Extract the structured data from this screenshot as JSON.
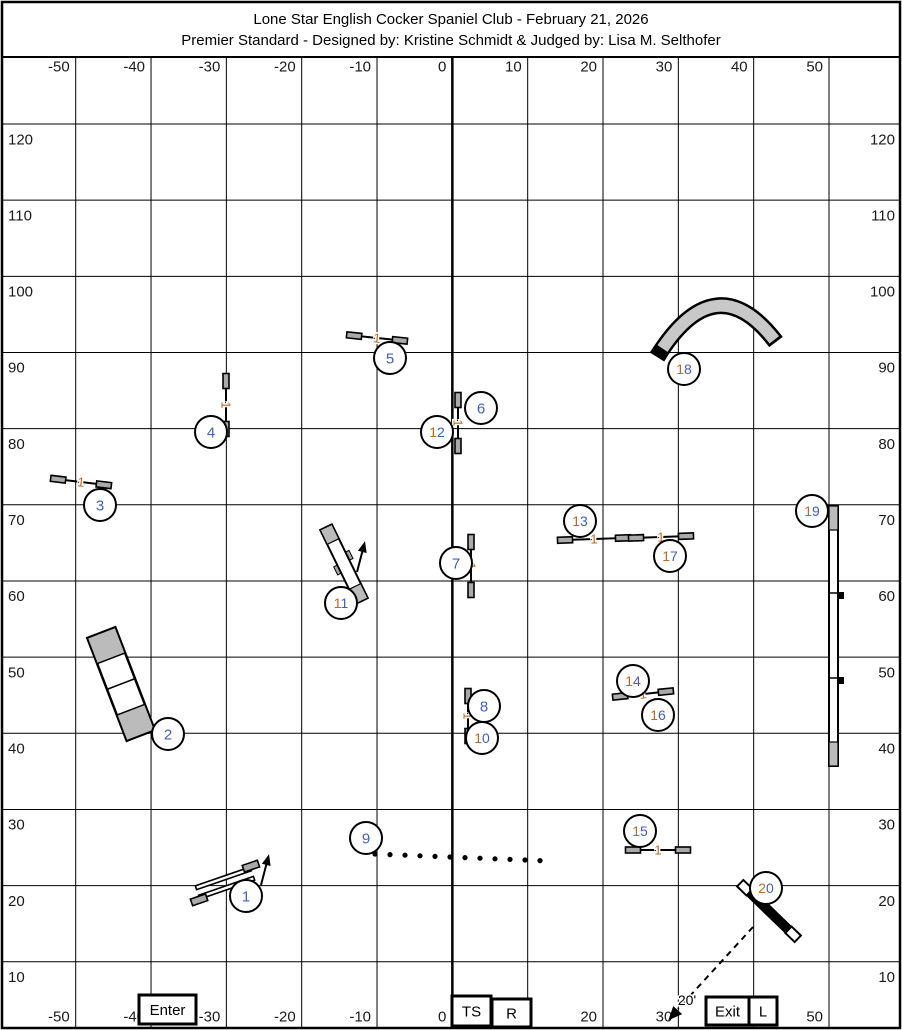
{
  "title": {
    "line1": "Lone Star English Cocker Spaniel Club - February 21, 2026",
    "line2": "Premier Standard - Designed by: Kristine Schmidt & Judged by: Lisa M. Selthofer"
  },
  "colors": {
    "circle_digit_blue": "#4060c0",
    "circle_tens_orange": "#c06820",
    "bar_count_orange": "#c06820",
    "wing_gray": "#aaaaaa",
    "contact_gray": "#bbbbbb",
    "tunnel_gray": "#c8c8c8",
    "line_black": "#000000",
    "label_gray": "#1a1a1a"
  },
  "grid": {
    "x_labels": [
      "-50",
      "-40",
      "-30",
      "-20",
      "-10",
      "0",
      "10",
      "20",
      "30",
      "40",
      "50"
    ],
    "y_labels": [
      "120",
      "110",
      "100",
      "90",
      "80",
      "70",
      "60",
      "50",
      "40",
      "30",
      "20",
      "10"
    ]
  },
  "boxes": [
    {
      "id": "enter-box",
      "label": "Enter",
      "x": 139,
      "y": 995,
      "w": 57,
      "h": 29
    },
    {
      "id": "ts-box",
      "label": "TS",
      "x": 452,
      "y": 996,
      "w": 39,
      "h": 30
    },
    {
      "id": "r-box",
      "label": "R",
      "x": 492,
      "y": 999,
      "w": 39,
      "h": 28
    },
    {
      "id": "exit-box",
      "label": "Exit",
      "x": 706,
      "y": 997,
      "w": 43,
      "h": 28
    },
    {
      "id": "l-box",
      "label": "L",
      "x": 749,
      "y": 997,
      "w": 28,
      "h": 28
    }
  ],
  "exit_path": {
    "dash_from": [
      753,
      927
    ],
    "dash_to": [
      678,
      1009
    ],
    "arrow_tip": [
      675,
      1013
    ],
    "label": "20'",
    "label_pos": [
      687,
      1000
    ]
  },
  "obstacles": [
    {
      "num": "1",
      "type": "double-jump",
      "circle": {
        "x": 246,
        "y": 896
      },
      "geom": {
        "cx": 225,
        "cy": 883,
        "angle": -19
      },
      "arrow": {
        "x1": 261,
        "y1": 885,
        "x2": 267,
        "y2": 862
      }
    },
    {
      "num": "2",
      "type": "a-frame",
      "circle": {
        "x": 168,
        "y": 734
      },
      "geom": {
        "cx": 121,
        "cy": 684,
        "angle": -21,
        "w": 30,
        "l": 110
      }
    },
    {
      "num": "3",
      "type": "winged-jump",
      "bar_label": "1",
      "circle": {
        "x": 100,
        "y": 505
      },
      "geom": {
        "cx": 81,
        "cy": 482,
        "angle": 7,
        "half": 23
      }
    },
    {
      "num": "4",
      "type": "winged-jump",
      "bar_label": "1",
      "circle": {
        "x": 211,
        "y": 432
      },
      "geom": {
        "cx": 226,
        "cy": 405,
        "angle": 90,
        "half": 24
      }
    },
    {
      "num": "5",
      "type": "winged-jump",
      "bar_label": "1",
      "circle": {
        "x": 390,
        "y": 358
      },
      "geom": {
        "cx": 377,
        "cy": 338,
        "angle": 6,
        "half": 23
      }
    },
    {
      "num": "6",
      "type": "winged-jump",
      "bar_label": "1",
      "circle": {
        "x": 481,
        "y": 408
      },
      "geom": {
        "cx": 458,
        "cy": 423,
        "angle": 90,
        "half": 23
      }
    },
    {
      "num": "7",
      "type": "winged-jump",
      "bar_label": "1",
      "circle": {
        "x": 456,
        "y": 563
      },
      "geom": {
        "cx": 471,
        "cy": 566,
        "angle": 90,
        "half": 24
      }
    },
    {
      "num": "8",
      "type": "winged-jump",
      "bar_label": "1",
      "circle": {
        "x": 484,
        "y": 706
      },
      "geom": {
        "cx": 468,
        "cy": 716,
        "angle": 90,
        "half": 20
      }
    },
    {
      "num": "9",
      "type": "weave-poles",
      "circle": {
        "x": 366,
        "y": 838
      },
      "geom": {
        "x0": 375,
        "y0": 854,
        "dx": 15,
        "dy": 0.6,
        "count": 12
      }
    },
    {
      "num": "10",
      "type": "circle-only",
      "circle": {
        "x": 482,
        "y": 738
      }
    },
    {
      "num": "11",
      "type": "teeter",
      "circle": {
        "x": 341,
        "y": 603
      },
      "geom": {
        "cx": 344,
        "cy": 564,
        "angle": -26,
        "w": 13,
        "l": 82
      },
      "arrow": {
        "x1": 357,
        "y1": 572,
        "x2": 363,
        "y2": 549
      }
    },
    {
      "num": "12",
      "type": "circle-only",
      "circle": {
        "x": 437,
        "y": 432
      }
    },
    {
      "num": "13",
      "type": "winged-jump",
      "bar_label": "1",
      "circle": {
        "x": 580,
        "y": 521
      },
      "geom": {
        "cx": 594,
        "cy": 539,
        "angle": -2,
        "half": 29
      }
    },
    {
      "num": "14",
      "type": "winged-jump",
      "bar_label": "1",
      "circle": {
        "x": 633,
        "y": 681
      },
      "geom": {
        "cx": 643,
        "cy": 694,
        "angle": -6,
        "half": 23
      }
    },
    {
      "num": "15",
      "type": "winged-jump",
      "bar_label": "1",
      "circle": {
        "x": 640,
        "y": 831
      },
      "geom": {
        "cx": 658,
        "cy": 850,
        "angle": 0,
        "half": 25
      }
    },
    {
      "num": "16",
      "type": "circle-only",
      "circle": {
        "x": 658,
        "y": 715
      }
    },
    {
      "num": "17",
      "type": "winged-jump",
      "bar_label": "1",
      "circle": {
        "x": 670,
        "y": 556
      },
      "geom": {
        "cx": 661,
        "cy": 537,
        "angle": -2,
        "half": 25
      }
    },
    {
      "num": "18",
      "type": "tunnel",
      "circle": {
        "x": 684,
        "y": 369
      },
      "geom": {
        "p0": [
          657,
          357
        ],
        "c": [
          715.5,
          262.5
        ],
        "p1": [
          776,
          342
        ]
      }
    },
    {
      "num": "19",
      "type": "dogwalk",
      "circle": {
        "x": 812,
        "y": 511
      },
      "geom": {
        "x": 829,
        "y": 506,
        "w": 9,
        "len": 260,
        "contact": 24,
        "ticks": [
          593,
          678
        ]
      }
    },
    {
      "num": "20",
      "type": "panel-jump",
      "circle": {
        "x": 766,
        "y": 888
      },
      "geom": {
        "cx": 769,
        "cy": 911,
        "angle": 44
      }
    }
  ]
}
